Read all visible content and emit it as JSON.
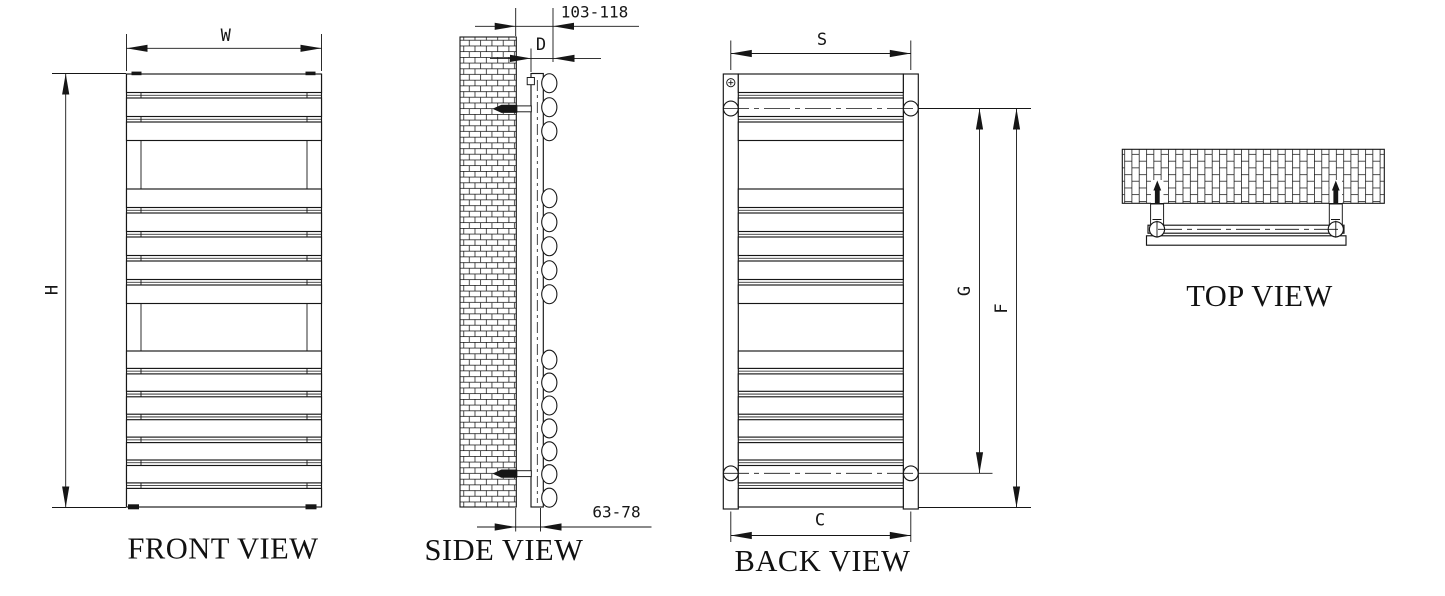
{
  "drawing": {
    "front": {
      "label": "FRONT VIEW",
      "width_label": "W",
      "height_label": "H"
    },
    "side": {
      "label": "SIDE VIEW",
      "wall_to_front_range": "103-118",
      "depth_label": "D",
      "wall_to_back_range": "63-78"
    },
    "back": {
      "label": "BACK VIEW",
      "bracket_span_label": "S",
      "bracket_height_label": "G",
      "overall_height_label": "F",
      "bottom_span_label": "C"
    },
    "top": {
      "label": "TOP VIEW"
    },
    "colors": {
      "line": "#161616",
      "background": "#ffffff"
    }
  }
}
